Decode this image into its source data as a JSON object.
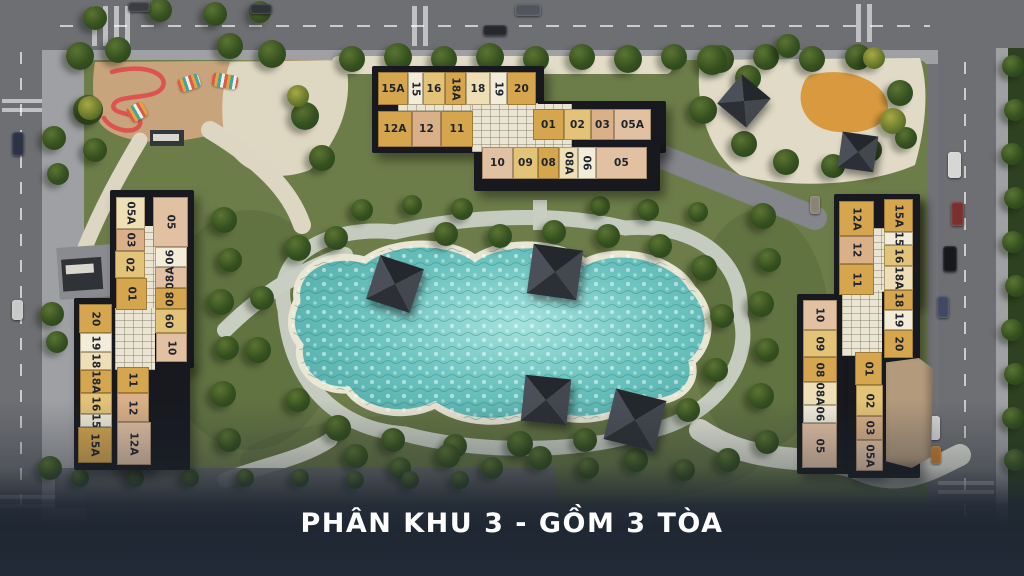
{
  "caption": {
    "text": "PHÂN KHU 3 - GỒM 3 TÒA",
    "bar_color": "#212a36",
    "text_color": "#ffffff"
  },
  "palette": {
    "gold": "#d5a64e",
    "gold2": "#e3c377",
    "tan": "#d9b087",
    "cream": "#eedfb6",
    "white": "#f2ecd9",
    "blush": "#e2c1a3"
  },
  "buildings": [
    {
      "id": "block-top",
      "label": "top tower",
      "units": [
        [
          "15A",
          378,
          72,
          30,
          33,
          "gold",
          "h"
        ],
        [
          "15",
          408,
          72,
          15,
          33,
          "white",
          "d"
        ],
        [
          "16",
          423,
          72,
          22,
          33,
          "gold2",
          "h"
        ],
        [
          "18A",
          445,
          72,
          21,
          33,
          "gold",
          "d"
        ],
        [
          "18",
          466,
          72,
          24,
          33,
          "cream",
          "h"
        ],
        [
          "19",
          490,
          72,
          17,
          33,
          "white",
          "d"
        ],
        [
          "20",
          507,
          72,
          29,
          33,
          "gold",
          "h"
        ],
        [
          "12A",
          378,
          111,
          34,
          36,
          "gold",
          "h"
        ],
        [
          "12",
          412,
          111,
          29,
          36,
          "tan",
          "h"
        ],
        [
          "11",
          441,
          111,
          32,
          36,
          "gold",
          "h"
        ],
        [
          "01",
          533,
          109,
          31,
          31,
          "gold",
          "h"
        ],
        [
          "02",
          564,
          109,
          27,
          31,
          "gold2",
          "h"
        ],
        [
          "03",
          591,
          109,
          23,
          31,
          "tan",
          "h"
        ],
        [
          "05A",
          614,
          109,
          37,
          31,
          "blush",
          "h"
        ],
        [
          "10",
          482,
          147,
          31,
          32,
          "blush",
          "h"
        ],
        [
          "09",
          513,
          147,
          25,
          32,
          "gold2",
          "h"
        ],
        [
          "08",
          538,
          147,
          21,
          32,
          "gold",
          "h"
        ],
        [
          "08A",
          559,
          147,
          19,
          32,
          "cream",
          "d"
        ],
        [
          "06",
          578,
          147,
          18,
          32,
          "white",
          "d"
        ],
        [
          "05",
          596,
          147,
          51,
          32,
          "blush",
          "h"
        ]
      ]
    },
    {
      "id": "block-left",
      "label": "left tower",
      "units": [
        [
          "05A",
          116,
          197,
          29,
          32,
          "cream",
          "d"
        ],
        [
          "03",
          116,
          229,
          29,
          22,
          "tan",
          "d"
        ],
        [
          "02",
          115,
          251,
          30,
          27,
          "gold2",
          "d"
        ],
        [
          "01",
          116,
          278,
          31,
          32,
          "gold",
          "d"
        ],
        [
          "05",
          153,
          197,
          35,
          50,
          "blush",
          "d"
        ],
        [
          "06",
          155,
          247,
          32,
          20,
          "white",
          "u"
        ],
        [
          "08A",
          155,
          267,
          32,
          21,
          "blush",
          "u"
        ],
        [
          "08",
          155,
          288,
          32,
          21,
          "gold",
          "u"
        ],
        [
          "09",
          155,
          309,
          32,
          24,
          "gold2",
          "u"
        ],
        [
          "10",
          156,
          333,
          31,
          29,
          "blush",
          "d"
        ],
        [
          "20",
          79,
          304,
          33,
          29,
          "gold",
          "d"
        ],
        [
          "19",
          80,
          333,
          32,
          19,
          "white",
          "d"
        ],
        [
          "18",
          80,
          352,
          32,
          18,
          "cream",
          "d"
        ],
        [
          "18A",
          80,
          370,
          32,
          23,
          "gold",
          "d"
        ],
        [
          "16",
          80,
          393,
          32,
          21,
          "gold2",
          "d"
        ],
        [
          "15",
          80,
          414,
          32,
          13,
          "white",
          "d"
        ],
        [
          "15A",
          78,
          427,
          34,
          36,
          "gold",
          "d"
        ],
        [
          "11",
          117,
          367,
          32,
          26,
          "gold",
          "d"
        ],
        [
          "12",
          117,
          393,
          32,
          29,
          "tan",
          "d"
        ],
        [
          "12A",
          117,
          422,
          34,
          43,
          "blush",
          "d"
        ]
      ]
    },
    {
      "id": "block-right",
      "label": "right tower",
      "units": [
        [
          "12A",
          839,
          201,
          35,
          35,
          "gold",
          "d"
        ],
        [
          "12",
          839,
          236,
          35,
          28,
          "tan",
          "d"
        ],
        [
          "11",
          839,
          264,
          35,
          31,
          "gold",
          "d"
        ],
        [
          "10",
          803,
          300,
          34,
          30,
          "blush",
          "d"
        ],
        [
          "09",
          803,
          330,
          34,
          27,
          "gold2",
          "d"
        ],
        [
          "08",
          803,
          357,
          34,
          25,
          "gold",
          "d"
        ],
        [
          "08A",
          803,
          382,
          34,
          23,
          "cream",
          "d"
        ],
        [
          "06",
          803,
          405,
          34,
          18,
          "white",
          "d"
        ],
        [
          "05",
          802,
          423,
          35,
          45,
          "blush",
          "d"
        ],
        [
          "15A",
          884,
          199,
          29,
          33,
          "gold",
          "d"
        ],
        [
          "15",
          884,
          232,
          29,
          13,
          "white",
          "d"
        ],
        [
          "16",
          884,
          245,
          29,
          21,
          "gold2",
          "d"
        ],
        [
          "18A",
          884,
          266,
          29,
          24,
          "cream",
          "d"
        ],
        [
          "18",
          884,
          290,
          29,
          20,
          "gold",
          "d"
        ],
        [
          "19",
          884,
          310,
          29,
          20,
          "white",
          "d"
        ],
        [
          "20",
          884,
          330,
          29,
          28,
          "gold",
          "d"
        ],
        [
          "01",
          855,
          352,
          27,
          33,
          "gold",
          "d"
        ],
        [
          "02",
          856,
          385,
          27,
          31,
          "gold2",
          "d"
        ],
        [
          "03",
          856,
          416,
          27,
          24,
          "tan",
          "d"
        ],
        [
          "05A",
          856,
          440,
          27,
          31,
          "blush",
          "d"
        ]
      ]
    }
  ]
}
